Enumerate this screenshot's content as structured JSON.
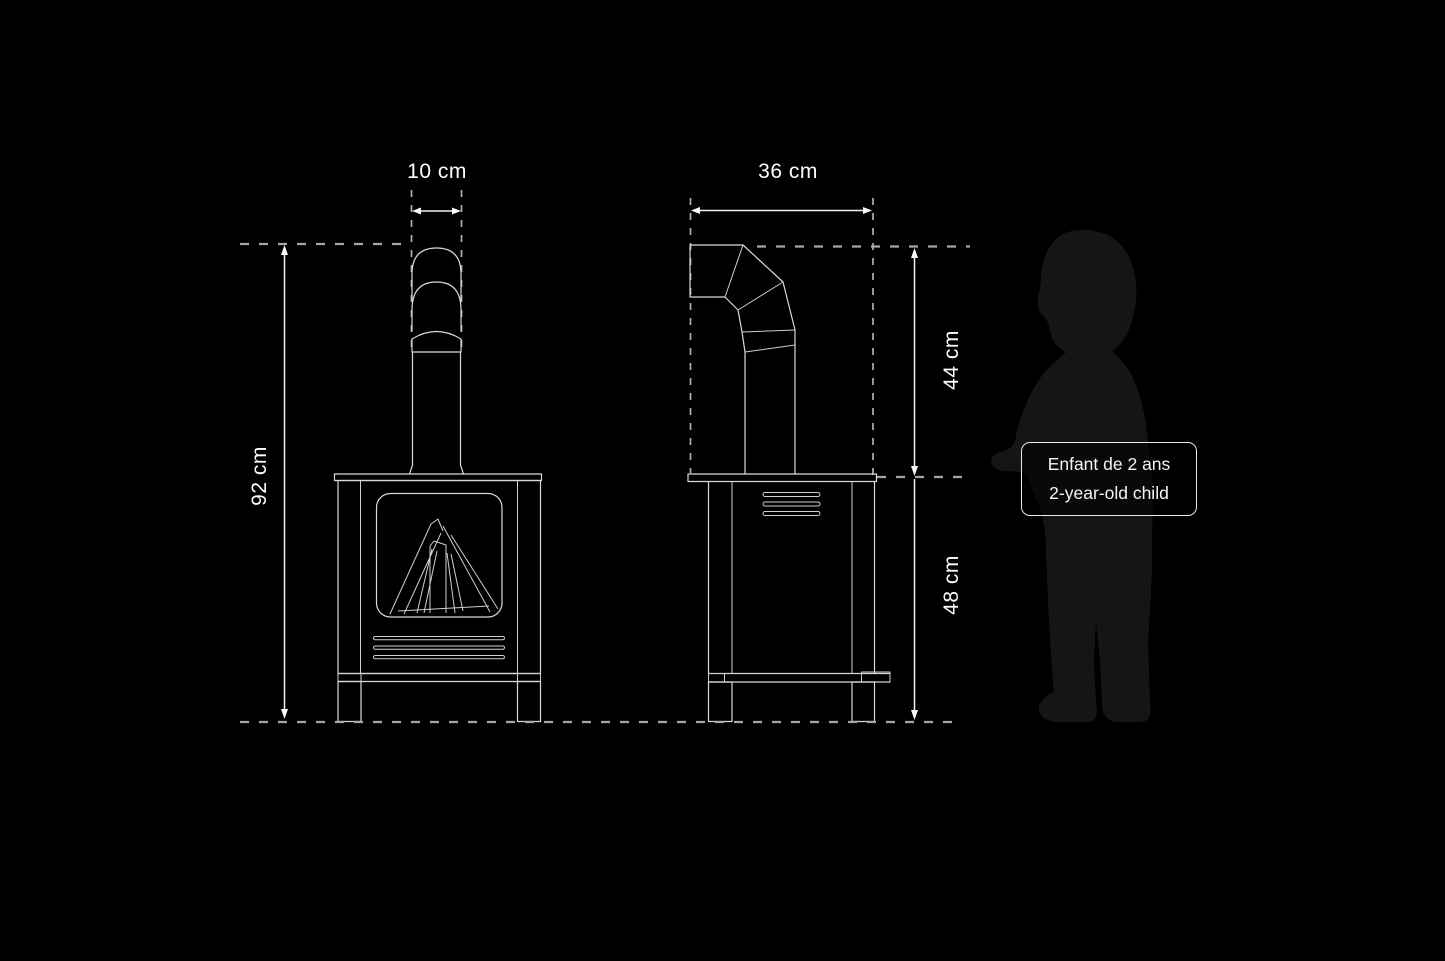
{
  "diagram_title": "wood-stove-dimension-drawing",
  "dimensions": {
    "front_chimney_width": "10 cm",
    "front_total_height": "92 cm",
    "side_depth": "36 cm",
    "side_pipe_height": "44 cm",
    "side_body_height": "48 cm"
  },
  "label": {
    "line1": "Enfant de 2 ans",
    "line2": "2-year-old child"
  },
  "colors": {
    "background": "#000000",
    "drawing_line": "#d9d9d9",
    "dashed_line": "#a6a6a6",
    "dimension_line": "#f2f2f2",
    "text": "#fdfdfd",
    "child_silhouette": "#151515",
    "label_border": "#e9e9e9"
  }
}
